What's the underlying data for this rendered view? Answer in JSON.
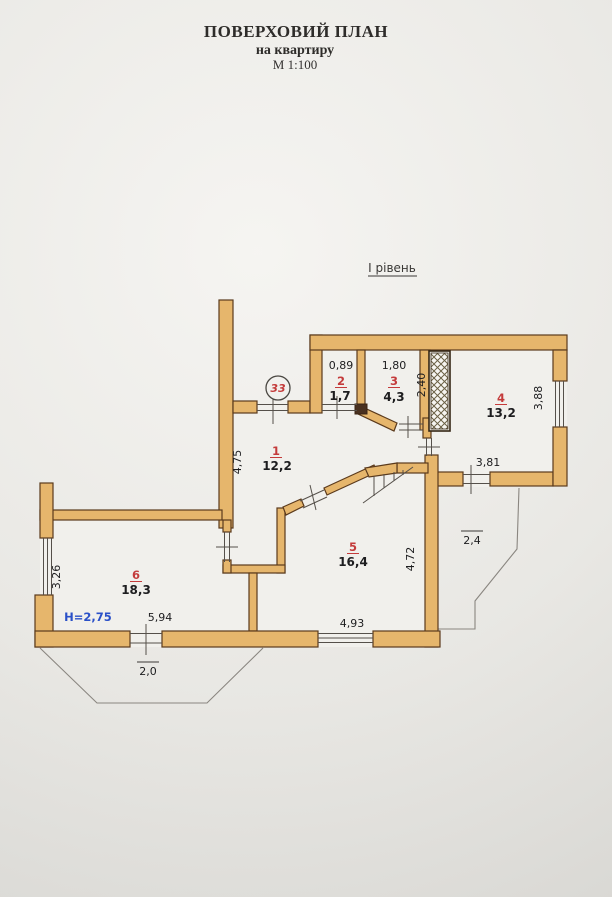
{
  "header": {
    "title": "ПОВЕРХОВИЙ ПЛАН",
    "subtitle": "на квартиру",
    "scale": "М 1:100"
  },
  "plan": {
    "level_label": "І рівень",
    "apartment_number": "33",
    "ceiling_height": "H=2,75"
  },
  "rooms": [
    {
      "number": "1",
      "area": "12,2"
    },
    {
      "number": "2",
      "area": "1,7"
    },
    {
      "number": "3",
      "area": "4,3"
    },
    {
      "number": "4",
      "area": "13,2"
    },
    {
      "number": "5",
      "area": "16,4"
    },
    {
      "number": "6",
      "area": "18,3"
    }
  ],
  "dimensions": {
    "room2_width": "0,89",
    "room3_width": "1,80",
    "room3_depth": "2,40",
    "room4_window": "3,88",
    "room4_bottom": "3,81",
    "room1_depth": "4,75",
    "room5_width": "4,93",
    "room5_depth": "4,72",
    "room6_window": "3,26",
    "room6_width": "5,94",
    "balcony_left": "2,0",
    "balcony_right": "2,4"
  },
  "colors": {
    "wall_fill": "#e6b66c",
    "wall_stroke": "#5b3a1c",
    "room_number": "#c43b3b",
    "dimension_text": "#1d1d1f",
    "height_text": "#2a50c8"
  }
}
